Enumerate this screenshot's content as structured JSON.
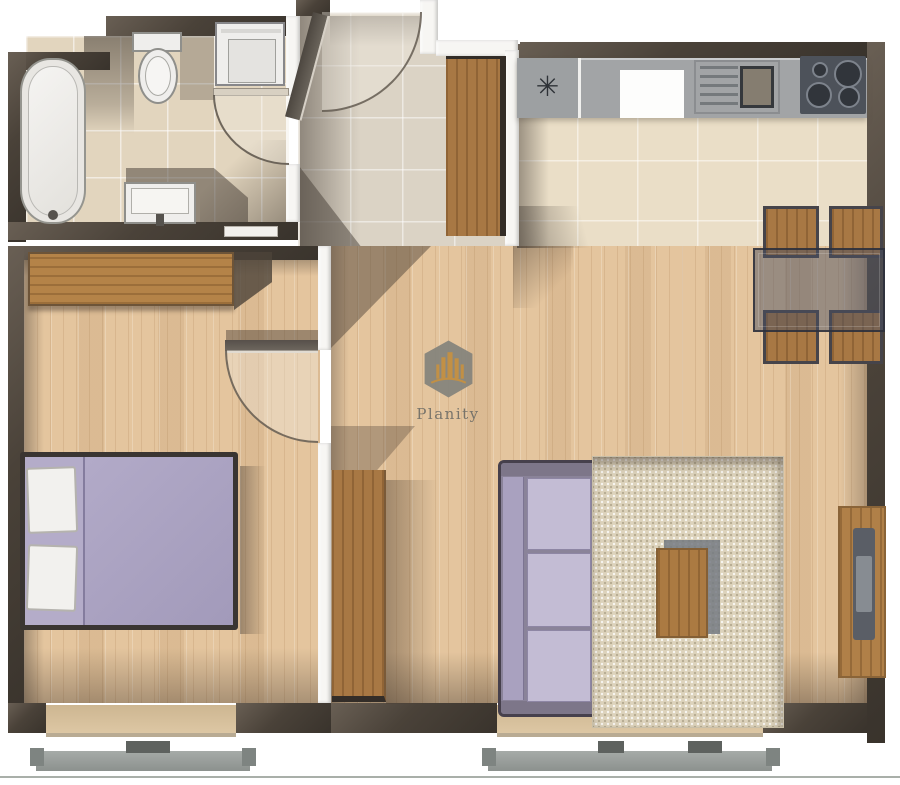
{
  "scene": {
    "kind": "apartment-floor-plan-3d-render",
    "view": "top-down"
  },
  "watermark": {
    "brand": "Planity",
    "logo_icon": "hexagon-skyline-icon"
  },
  "kitchen": {
    "appliance_symbol": "✳"
  },
  "rooms": {
    "bathroom": {
      "items": [
        "bathtub",
        "toilet",
        "washing-machine",
        "wash-basin",
        "swing-door"
      ]
    },
    "hallway": {
      "items": [
        "entry-swing-door",
        "wardrobe"
      ]
    },
    "kitchen": {
      "items": [
        "counter",
        "sink-with-drainboard",
        "cooktop-4-burner",
        "glass-dining-table",
        "dining-chairs-x4"
      ]
    },
    "bedroom": {
      "items": [
        "wardrobe",
        "double-bed-2-pillows",
        "swing-door",
        "window"
      ]
    },
    "living_room": {
      "items": [
        "tv-stand",
        "sofa-3-seat",
        "rug",
        "coffee-table",
        "tv-wall-panel",
        "window"
      ]
    }
  },
  "palette": {
    "exterior_wall": "#4a4239",
    "interior_wall": "#f7f6f3",
    "bathroom_tile": "#e2d5be",
    "hall_tile": "#dbd3c5",
    "kitchen_tile": "#eadec7",
    "wood_floor": "#e4c59e",
    "furniture_wood": "#a87844",
    "upholstery_lavender": "#b1a9c7",
    "rug_beige": "#ddd3bc",
    "counter_gray": "#a2a4a6",
    "cooktop_dark": "#4d525a",
    "fixture_white": "#efeeec",
    "logo_gray": "#85847c",
    "logo_orange": "#c08d3f"
  }
}
